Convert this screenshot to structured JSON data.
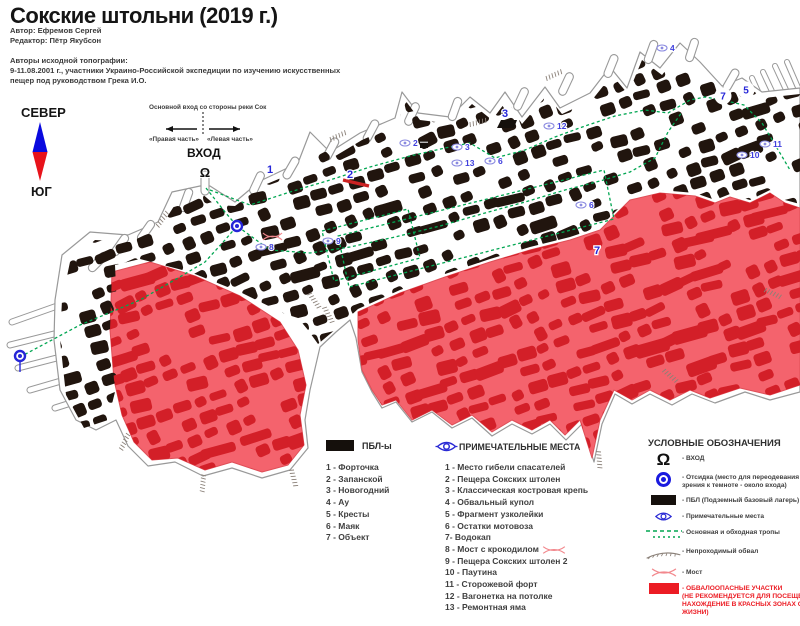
{
  "title": "Сокские штольни (2019 г.)",
  "credits": {
    "author": "Автор: Ефремов Сергей",
    "editor": "Редактор: Пётр Якубсон",
    "topo_heading": "Авторы исходной топографии:",
    "topo_line1": "9-11.08.2001 г., участники Украино-Российской экспедиции по изучению искусственных",
    "topo_line2": "пещер под руководством Грека И.О."
  },
  "compass": {
    "north": "СЕВЕР",
    "south": "ЮГ"
  },
  "entrance_annotation": {
    "note": "Основной вход со стороны реки Сок",
    "right_part": "«Правая часть»",
    "left_part": "«Левая часть»",
    "entrance": "ВХОД"
  },
  "legend_pbl": {
    "title": "ПБЛ-ы",
    "items": [
      "1 - Форточка",
      "2 - Запанской",
      "3 - Новогодний",
      "4 - Ау",
      "5 - Кресты",
      "6 - Маяк",
      "7 - Объект"
    ]
  },
  "legend_places": {
    "title": "ПРИМЕЧАТЕЛЬНЫЕ МЕСТА",
    "items": [
      "1 - Место гибели спасателей",
      "2 - Пещера Сокских штолен",
      "3 - Классическая костровая крепь",
      "4 - Обвальный купол",
      "5 - Фрагмент узколейки",
      "6 - Остатки мотовоза",
      "7- Водокап",
      "8 - Мост с крокодилом",
      "9 - Пещера Сокских штолен 2",
      "10 - Паутина",
      "11 - Сторожевой форт",
      "12 - Вагонетка на потолке",
      "13 - Ремонтная яма"
    ]
  },
  "legend_symbols": {
    "title": "УСЛОВНЫЕ ОБОЗНАЧЕНИЯ",
    "items": [
      {
        "icon": "entrance",
        "lines": [
          "- ВХОД"
        ]
      },
      {
        "icon": "otsidka",
        "lines": [
          "- Отсидка (место для переодевания и адаптации",
          "зрения к темноте - около входа)"
        ]
      },
      {
        "icon": "pbl",
        "lines": [
          "- ПБЛ (Подземный базовый лагерь)"
        ]
      },
      {
        "icon": "places",
        "lines": [
          "- Примечательные места"
        ]
      },
      {
        "icon": "paths",
        "lines": [
          "- Основная и обходная тропы"
        ]
      },
      {
        "icon": "collapse",
        "lines": [
          "- Непроходимый обвал"
        ]
      },
      {
        "icon": "bridge",
        "lines": [
          "- Мост"
        ]
      },
      {
        "icon": "danger",
        "danger": true,
        "lines": [
          "- ОБВАЛООПАСНЫЕ УЧАСТКИ",
          "(НЕ РЕКОМЕНДУЕТСЯ ДЛЯ ПОСЕЩЕНИЯ",
          "НАХОЖДЕНИЕ В КРАСНЫХ ЗОНАХ  ОПАСНО ДЛЯ",
          "ЖИЗНИ)"
        ]
      }
    ]
  },
  "map": {
    "colors": {
      "pillar": "#21150e",
      "danger_fill": "#f4636d",
      "danger_pillar": "#d31f28",
      "route": "#00a651",
      "marker_blue": "#2626d8",
      "eye_blue": "#8a8ae0",
      "outline": "#999999",
      "accent_red": "#ec1c24",
      "compass_blue": "#0a0adf",
      "compass_red": "#e8131b"
    },
    "markers": [
      {
        "t": "omega",
        "n": "Ω",
        "x": 205,
        "y": 177
      },
      {
        "t": "bold",
        "n": "1",
        "x": 270,
        "y": 169
      },
      {
        "t": "bold",
        "n": "2",
        "x": 350,
        "y": 174
      },
      {
        "t": "bold",
        "n": "3",
        "x": 505,
        "y": 113
      },
      {
        "t": "bold",
        "n": "7",
        "x": 597,
        "y": 250
      },
      {
        "t": "circle",
        "n": "7",
        "x": 723,
        "y": 96
      },
      {
        "t": "circle",
        "n": "5",
        "x": 746,
        "y": 90
      },
      {
        "t": "eye",
        "n": "2",
        "x": 414,
        "y": 143
      },
      {
        "t": "eye",
        "n": "3",
        "x": 466,
        "y": 147
      },
      {
        "t": "eye",
        "n": "12",
        "x": 558,
        "y": 126
      },
      {
        "t": "eye",
        "n": "13",
        "x": 466,
        "y": 163
      },
      {
        "t": "eye",
        "n": "6",
        "x": 499,
        "y": 161
      },
      {
        "t": "eye",
        "n": "6",
        "x": 590,
        "y": 205
      },
      {
        "t": "eye",
        "n": "9",
        "x": 337,
        "y": 241
      },
      {
        "t": "eye",
        "n": "8",
        "x": 270,
        "y": 247
      },
      {
        "t": "eye",
        "n": "4",
        "x": 671,
        "y": 48
      },
      {
        "t": "eye",
        "n": "10",
        "x": 751,
        "y": 155
      },
      {
        "t": "eye",
        "n": "11",
        "x": 774,
        "y": 144
      },
      {
        "t": "otsidka",
        "n": "",
        "x": 237,
        "y": 226
      },
      {
        "t": "otsidka",
        "n": "",
        "x": 20,
        "y": 356
      }
    ]
  }
}
